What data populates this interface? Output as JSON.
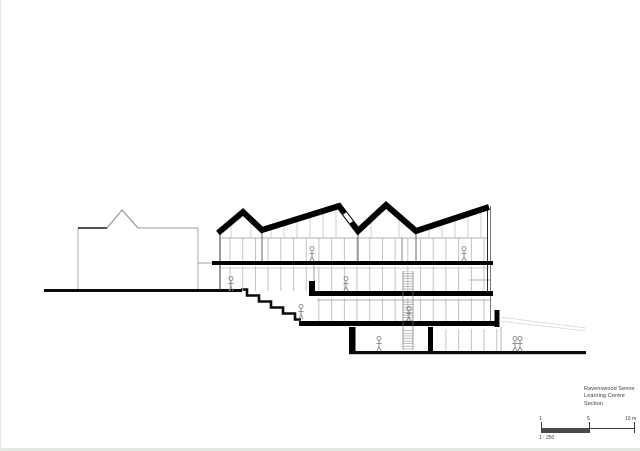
{
  "title_block": {
    "line1": "Ravenswood Senior",
    "line2": "Learning Centre",
    "line3": "Section"
  },
  "scale_bar": {
    "tick_labels": [
      "1",
      "5",
      "10 m"
    ],
    "ratio": "1 : 250"
  },
  "drawing": {
    "type": "architectural-section"
  },
  "colors": {
    "ink": "#000000",
    "light_line": "#b4b4b4",
    "text": "#3a3a3a",
    "page_edge": "#e4ece4"
  }
}
